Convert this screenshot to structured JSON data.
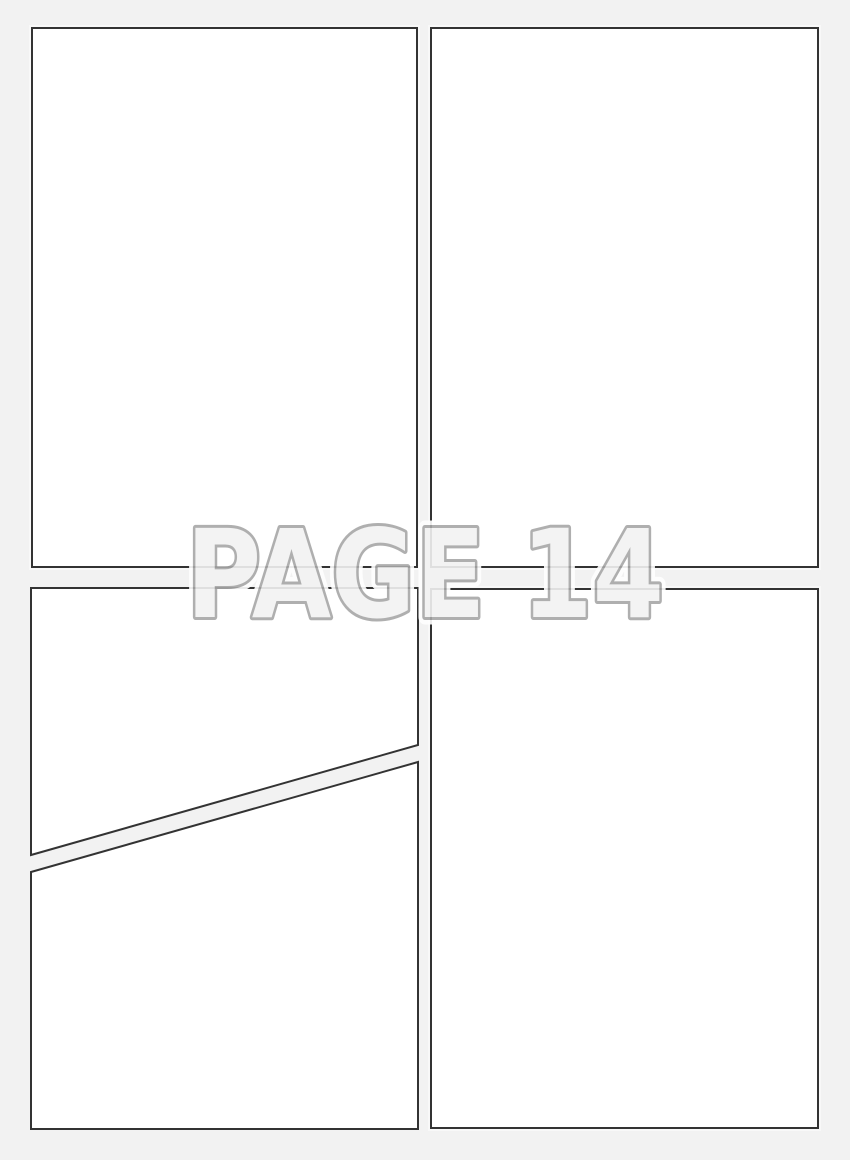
{
  "page_label": {
    "text": "PAGE 14"
  },
  "panels": {
    "panel_1": "blank comic panel top left",
    "panel_2": "blank comic panel top right",
    "panel_3a": "blank comic panel bottom left upper (diagonal cut)",
    "panel_3b": "blank comic panel bottom left lower (diagonal cut)",
    "panel_4": "blank comic panel bottom right"
  },
  "colors": {
    "page_background": "#f2f2f2",
    "panel_fill": "#ffffff",
    "panel_border": "#333333",
    "label_fill": "#f2f2f2",
    "label_outline": "#a7a7a7",
    "label_halo": "#ffffff"
  }
}
